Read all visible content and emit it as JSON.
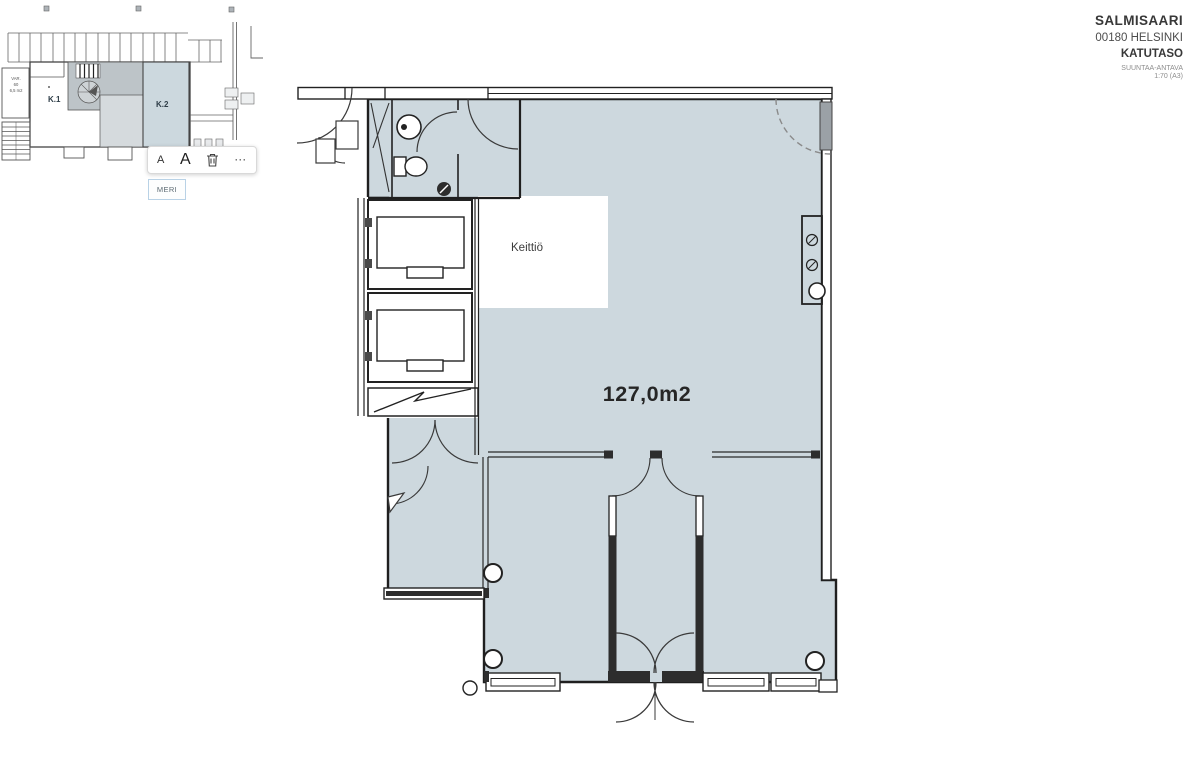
{
  "title_block": {
    "project": "SALMISAARI",
    "address": "00180 HELSINKI",
    "level": "KATUTASO",
    "note": "SUUNTAA-ANTAVA",
    "scale": "1:70 (A3)"
  },
  "overview": {
    "room_k1_label": "K.1",
    "room_k2_label": "K.2",
    "storage_label_line1": "VAR.",
    "storage_label_line2": "60",
    "storage_label_line3": "6,5 m2",
    "selected_tag": "MERI"
  },
  "toolbar": {
    "decrease_font_label": "A",
    "increase_font_label": "A",
    "more_label": "···"
  },
  "main_plan": {
    "kitchen_label": "Keittiö",
    "area_label": "127,0m2"
  },
  "colors": {
    "room_fill": "#cdd8de",
    "wall": "#1f1f1f",
    "tag_border": "#b9d2e6",
    "door_leaf_gray": "#9ba1a6"
  }
}
